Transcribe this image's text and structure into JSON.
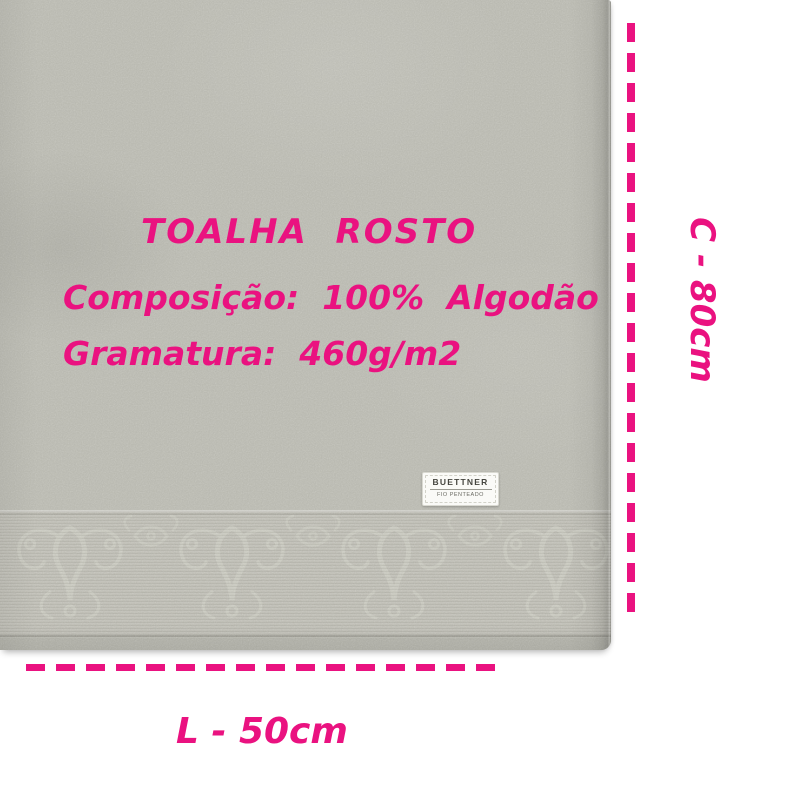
{
  "overlay": {
    "title": "TOALHA  ROSTO",
    "composition": "Composição:  100%  Algodão",
    "grammage": "Gramatura:  460g/m2"
  },
  "measurements": {
    "height_label": "C - 80cm",
    "length_label": "L - 50cm"
  },
  "tag": {
    "brand": "BUETTNER",
    "subtitle": "FIO PENTEADO"
  },
  "colors": {
    "accent_pink": "#EA1280",
    "towel_base": "#B6B6AD",
    "band": "#BABAB1",
    "background": "#FFFFFF",
    "tag_background": "#FAFAF7"
  }
}
